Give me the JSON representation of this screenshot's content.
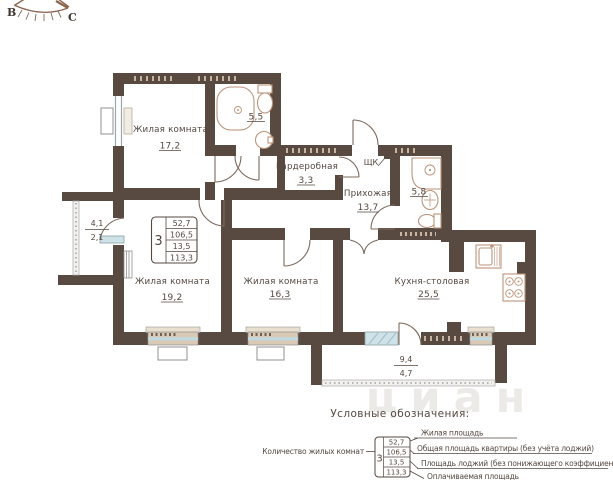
{
  "compass": {
    "east_label": "В",
    "north_label": "С"
  },
  "rooms": {
    "living1": {
      "name": "Жилая комната",
      "area": "17,2"
    },
    "living2": {
      "name": "Жилая комната",
      "area": "19,2"
    },
    "living3": {
      "name": "Жилая комната",
      "area": "16,3"
    },
    "kitchen": {
      "name": "Кухня-столовая",
      "area": "25,5"
    },
    "hallway": {
      "name": "Прихожая",
      "area": "13,7"
    },
    "wardrobe": {
      "name": "Гардеробная",
      "area": "3,3"
    },
    "bathroom1": {
      "area": "5,5"
    },
    "bathroom2": {
      "area": "5,8"
    },
    "loggia": {
      "area_full": "4,1",
      "area_reduced": "2,1"
    },
    "balcony": {
      "area_full": "9,4",
      "area_reduced": "4,7"
    }
  },
  "labels": {
    "electrical_box": "ЩК"
  },
  "stat_box": {
    "rooms_count": "3",
    "values": [
      "52,7",
      "106,5",
      "13,5",
      "113,3"
    ]
  },
  "legend": {
    "title": "Условные обозначения:",
    "rooms_count_label": "Количество жилых комнат",
    "rooms_count_value": "3",
    "rows": [
      {
        "value": "52,7",
        "label": "Жилая площадь"
      },
      {
        "value": "106,5",
        "label": "Общая площадь квартиры (без учёта лоджий)"
      },
      {
        "value": "13,5",
        "label": "Площадь лоджий (без понижающего коэффициента)"
      },
      {
        "value": "113,3",
        "label": "Оплачиваемая площадь"
      }
    ]
  },
  "watermark": "циан",
  "colors": {
    "wall": "#594a41",
    "fixture": "#bb9379",
    "text": "#55473f",
    "window_sill": "#d9c9b5",
    "glass": "#cfe2e7"
  }
}
